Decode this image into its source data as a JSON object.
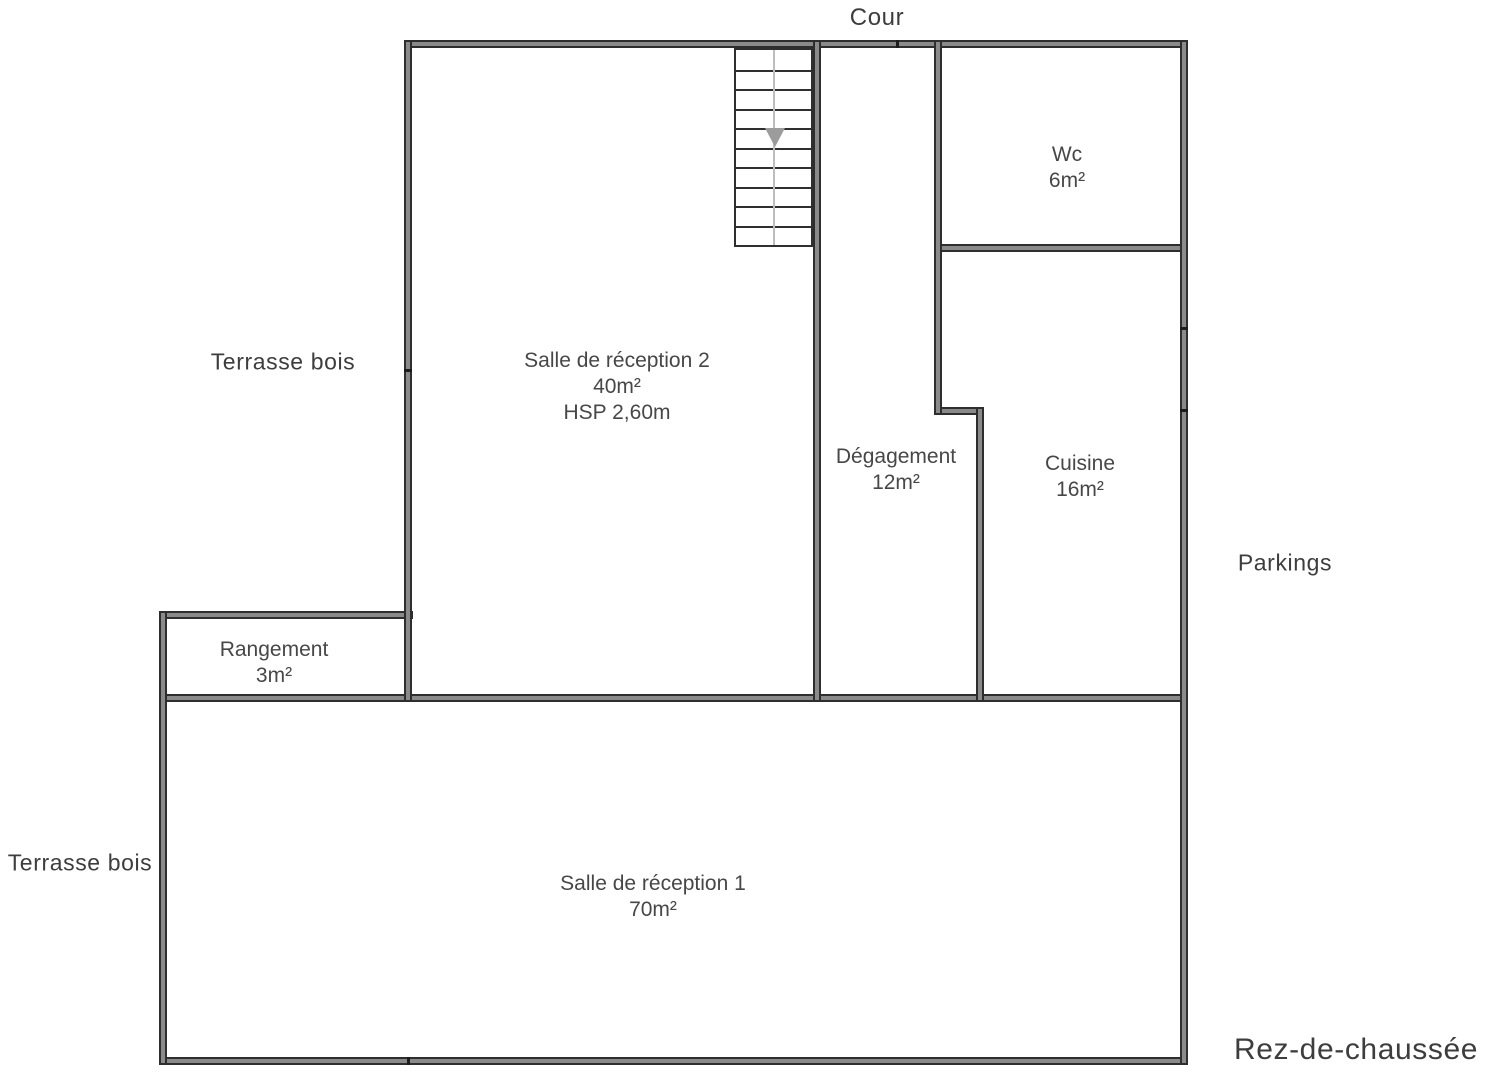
{
  "page": {
    "floor_title": "Rez-de-chaussée"
  },
  "colors": {
    "background": "#ffffff",
    "wall_fill": "#8a8a8a",
    "wall_edge": "#2e2e2e",
    "outside_label_text": "#3d3d3d",
    "room_label_text": "#474747",
    "stair_arrow": "#9c9c9c"
  },
  "floorplan": {
    "outside_labels": [
      {
        "id": "cour",
        "text": "Cour",
        "x": 877,
        "y": 18,
        "size": 24
      },
      {
        "id": "terrasse-bois-upper",
        "text": "Terrasse bois",
        "x": 283,
        "y": 362,
        "size": 23
      },
      {
        "id": "parkings",
        "text": "Parkings",
        "x": 1285,
        "y": 563,
        "size": 23
      },
      {
        "id": "terrasse-bois-lower",
        "text": "Terrasse bois",
        "x": 80,
        "y": 863,
        "size": 23
      },
      {
        "id": "floor-title",
        "text": "Rez-de-chaussée",
        "x": 1356,
        "y": 1050,
        "size": 30
      }
    ],
    "rooms": [
      {
        "id": "wc",
        "lines": [
          "Wc",
          "6m²"
        ],
        "x": 1067,
        "y": 168
      },
      {
        "id": "salle-de-reception-2",
        "lines": [
          "Salle de réception 2",
          "40m²",
          "HSP 2,60m"
        ],
        "x": 617,
        "y": 387
      },
      {
        "id": "degagement",
        "lines": [
          "Dégagement",
          "12m²"
        ],
        "x": 896,
        "y": 470
      },
      {
        "id": "cuisine",
        "lines": [
          "Cuisine",
          "16m²"
        ],
        "x": 1080,
        "y": 477
      },
      {
        "id": "rangement",
        "lines": [
          "Rangement",
          "3m²"
        ],
        "x": 274,
        "y": 663
      },
      {
        "id": "salle-de-reception-1",
        "lines": [
          "Salle de réception 1",
          "70m²"
        ],
        "x": 653,
        "y": 897
      }
    ],
    "walls": [
      {
        "id": "top",
        "x": 404,
        "y": 40,
        "w": 784,
        "h": 8
      },
      {
        "id": "wc-bottom",
        "x": 934,
        "y": 244,
        "w": 254,
        "h": 8
      },
      {
        "id": "degagement-step",
        "x": 934,
        "y": 407,
        "w": 50,
        "h": 8
      },
      {
        "id": "rangement-top",
        "x": 159,
        "y": 611,
        "w": 254,
        "h": 8
      },
      {
        "id": "middle",
        "x": 159,
        "y": 694,
        "w": 1029,
        "h": 8
      },
      {
        "id": "bottom",
        "x": 159,
        "y": 1057,
        "w": 1029,
        "h": 8
      },
      {
        "id": "left-upper",
        "x": 404,
        "y": 40,
        "w": 8,
        "h": 662
      },
      {
        "id": "stair-right",
        "x": 813,
        "y": 40,
        "w": 8,
        "h": 662
      },
      {
        "id": "wc-left",
        "x": 934,
        "y": 40,
        "w": 8,
        "h": 375
      },
      {
        "id": "cuisine-left",
        "x": 976,
        "y": 407,
        "w": 8,
        "h": 295
      },
      {
        "id": "right",
        "x": 1180,
        "y": 40,
        "w": 8,
        "h": 1025
      },
      {
        "id": "left-lower",
        "x": 159,
        "y": 611,
        "w": 8,
        "h": 454
      }
    ],
    "joints": [
      {
        "id": "top-wall-joint",
        "x": 896,
        "y": 40,
        "w": 3,
        "h": 8
      },
      {
        "id": "left-wall-joint",
        "x": 404,
        "y": 369,
        "w": 8,
        "h": 3
      },
      {
        "id": "right-wall-joint-1",
        "x": 1180,
        "y": 327,
        "w": 8,
        "h": 3
      },
      {
        "id": "right-wall-joint-2",
        "x": 1180,
        "y": 409,
        "w": 8,
        "h": 3
      },
      {
        "id": "bottom-wall-joint",
        "x": 407,
        "y": 1057,
        "w": 3,
        "h": 8
      }
    ],
    "stairs": {
      "x": 734,
      "y": 48,
      "w": 79,
      "h": 199,
      "treads": 9,
      "arrow": {
        "left": 29,
        "top": 78
      }
    }
  }
}
